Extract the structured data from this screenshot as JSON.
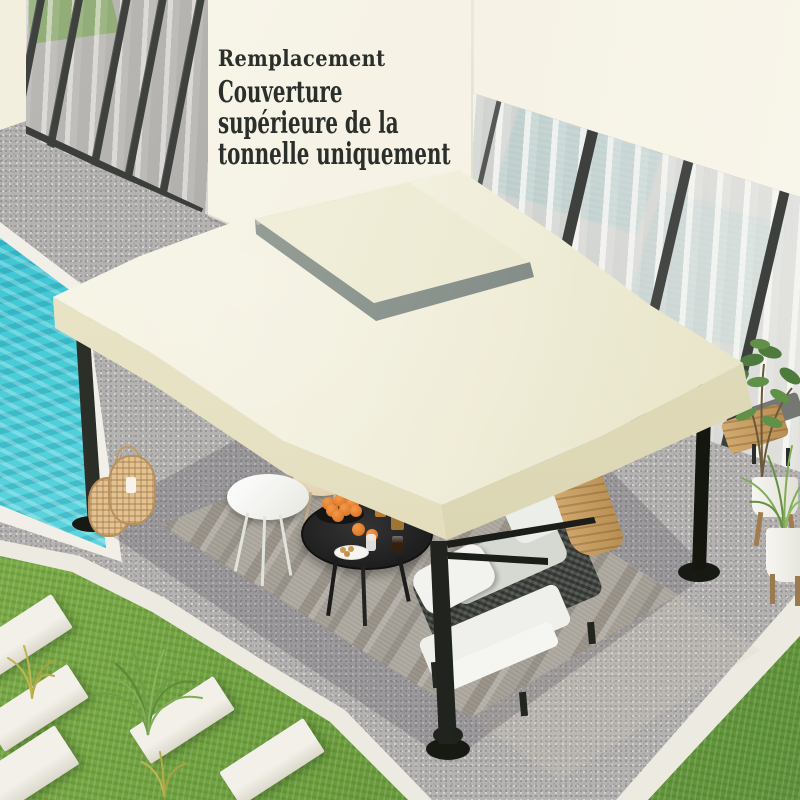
{
  "overlay": {
    "kicker": "Remplacement",
    "title_lines": [
      "Couverture",
      "supérieure de la",
      "tonnelle uniquement"
    ]
  },
  "palette": {
    "ink": "#2b2f2b",
    "wall-cream": "#f5f1e4",
    "canopy-cream": "#f0edd8",
    "canopy-valance": "#e6e1c2",
    "tier-gray": "#87908a",
    "frame-black": "#21241e",
    "pool-turquoise": "#3cc3d1",
    "grass-green": "#75a73f",
    "gravel-gray": "#b5b3b2",
    "rug-beige": "#cbc4b5",
    "stone-white": "#f2f0e9",
    "wood-tan": "#c6a068",
    "orange-fruit": "#dd7a2e",
    "curtain-gray": "#d9d7d3",
    "teal-glass": "#8fbcbd"
  }
}
